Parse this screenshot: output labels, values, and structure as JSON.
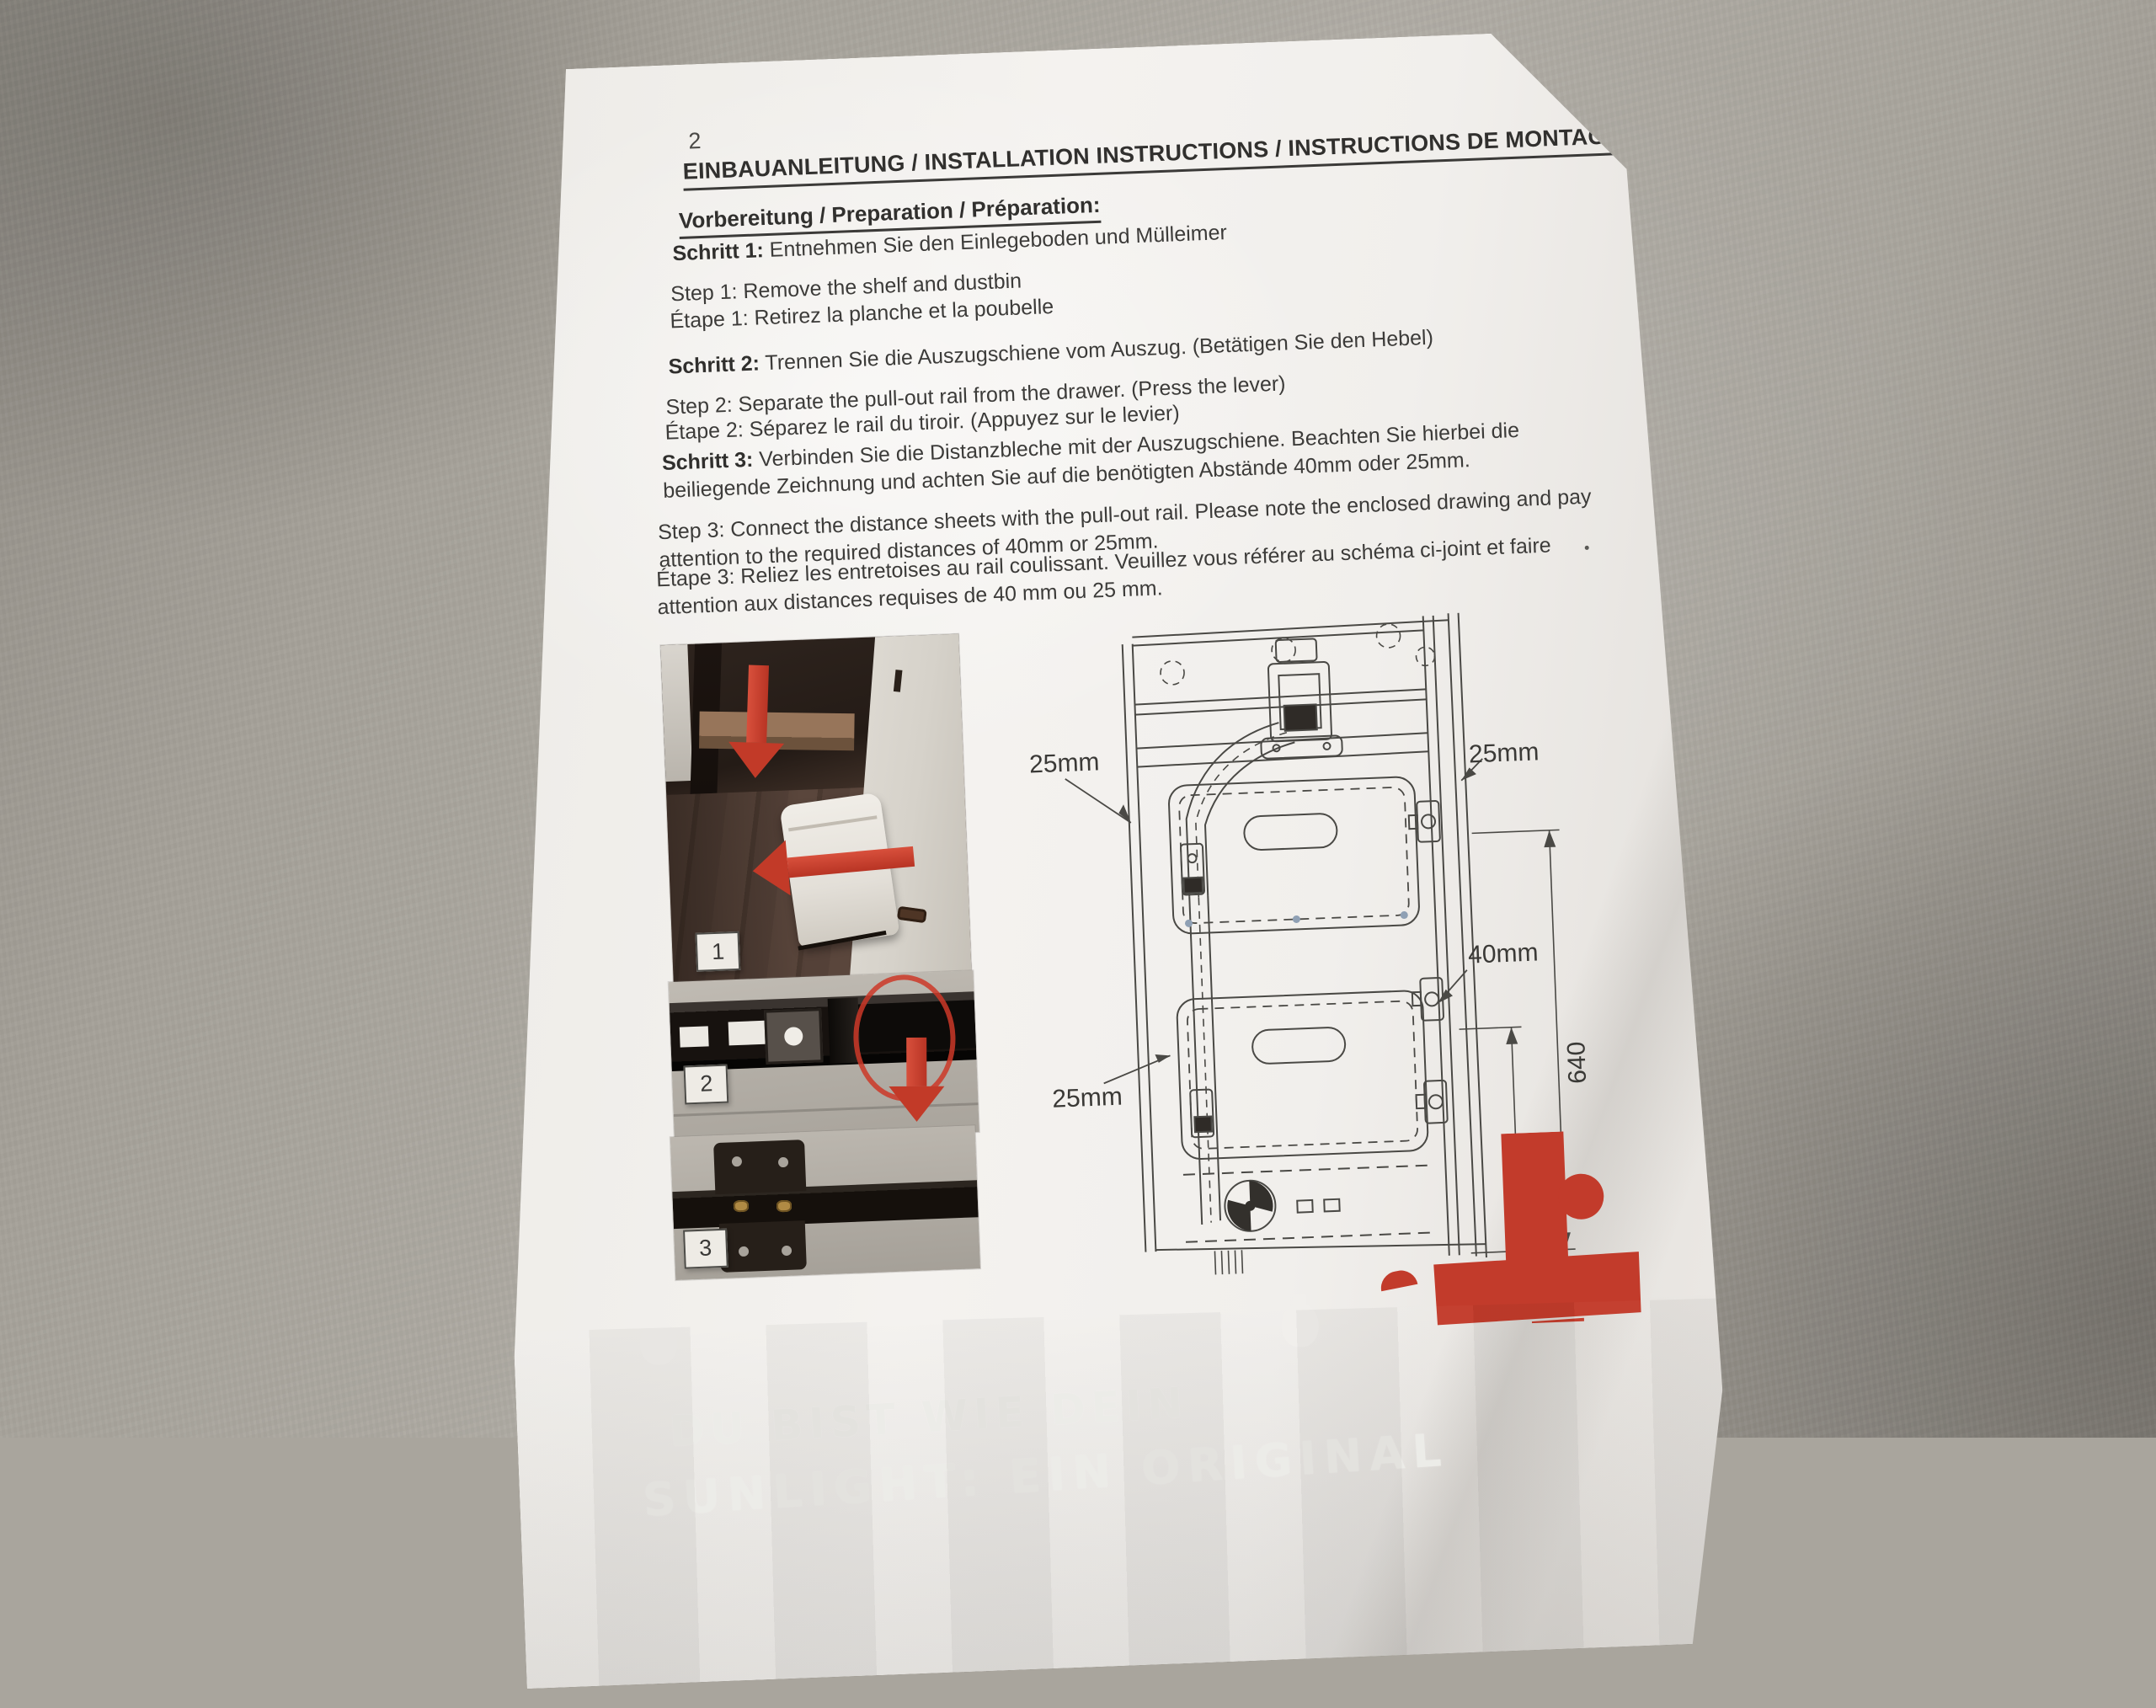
{
  "document": {
    "page_number": "2",
    "title": "EINBAUANLEITUNG / INSTALLATION INSTRUCTIONS / INSTRUCTIONS DE MONTAGE:",
    "section": "Vorbereitung / Preparation / Préparation:",
    "steps": [
      {
        "de_label": "Schritt 1:",
        "de_text": " Entnehmen Sie den Einlegeboden und Mülleimer",
        "en": "Step 1: Remove the shelf and dustbin",
        "fr": "Étape 1: Retirez la planche et la poubelle"
      },
      {
        "de_label": "Schritt 2:",
        "de_text": " Trennen Sie die Auszugschiene vom Auszug. (Betätigen Sie den Hebel)",
        "en": "Step 2: Separate the pull-out rail from the drawer. (Press the lever)",
        "fr": "Étape 2: Séparez le rail du tiroir. (Appuyez sur le levier)"
      },
      {
        "de_label": "Schritt 3:",
        "de_text": " Verbinden Sie die Distanzbleche mit der Auszugschiene. Beachten Sie hierbei die beiliegende Zeichnung und achten Sie auf die benötigten Abstände 40mm oder 25mm.",
        "en": "Step 3: Connect the distance sheets with the pull-out rail. Please note the enclosed drawing and pay attention to the required distances of 40mm or 25mm.",
        "fr": "Étape 3: Reliez les entretoises au rail coulissant. Veuillez vous référer au schéma ci-joint et faire attention aux distances requises de 40 mm ou 25 mm."
      }
    ],
    "figure_numbers": [
      "1",
      "2",
      "3"
    ],
    "diagram": {
      "label_top_left": "25mm",
      "label_top_right": "25mm",
      "label_mid_right": "40mm",
      "label_bottom_left": "25mm",
      "dim_height_total": "640",
      "dim_height_lower": "288"
    },
    "footer": {
      "tagline_line1": "DU BIST WIE DEIN",
      "tagline_line2": "SUNLIGHT: EIN ORIGINAL"
    }
  },
  "colors": {
    "accent_red": "#c23b2b",
    "paper": "#f2f0ed",
    "ink": "#3c3b39",
    "table_gray": "#a9a59d"
  }
}
